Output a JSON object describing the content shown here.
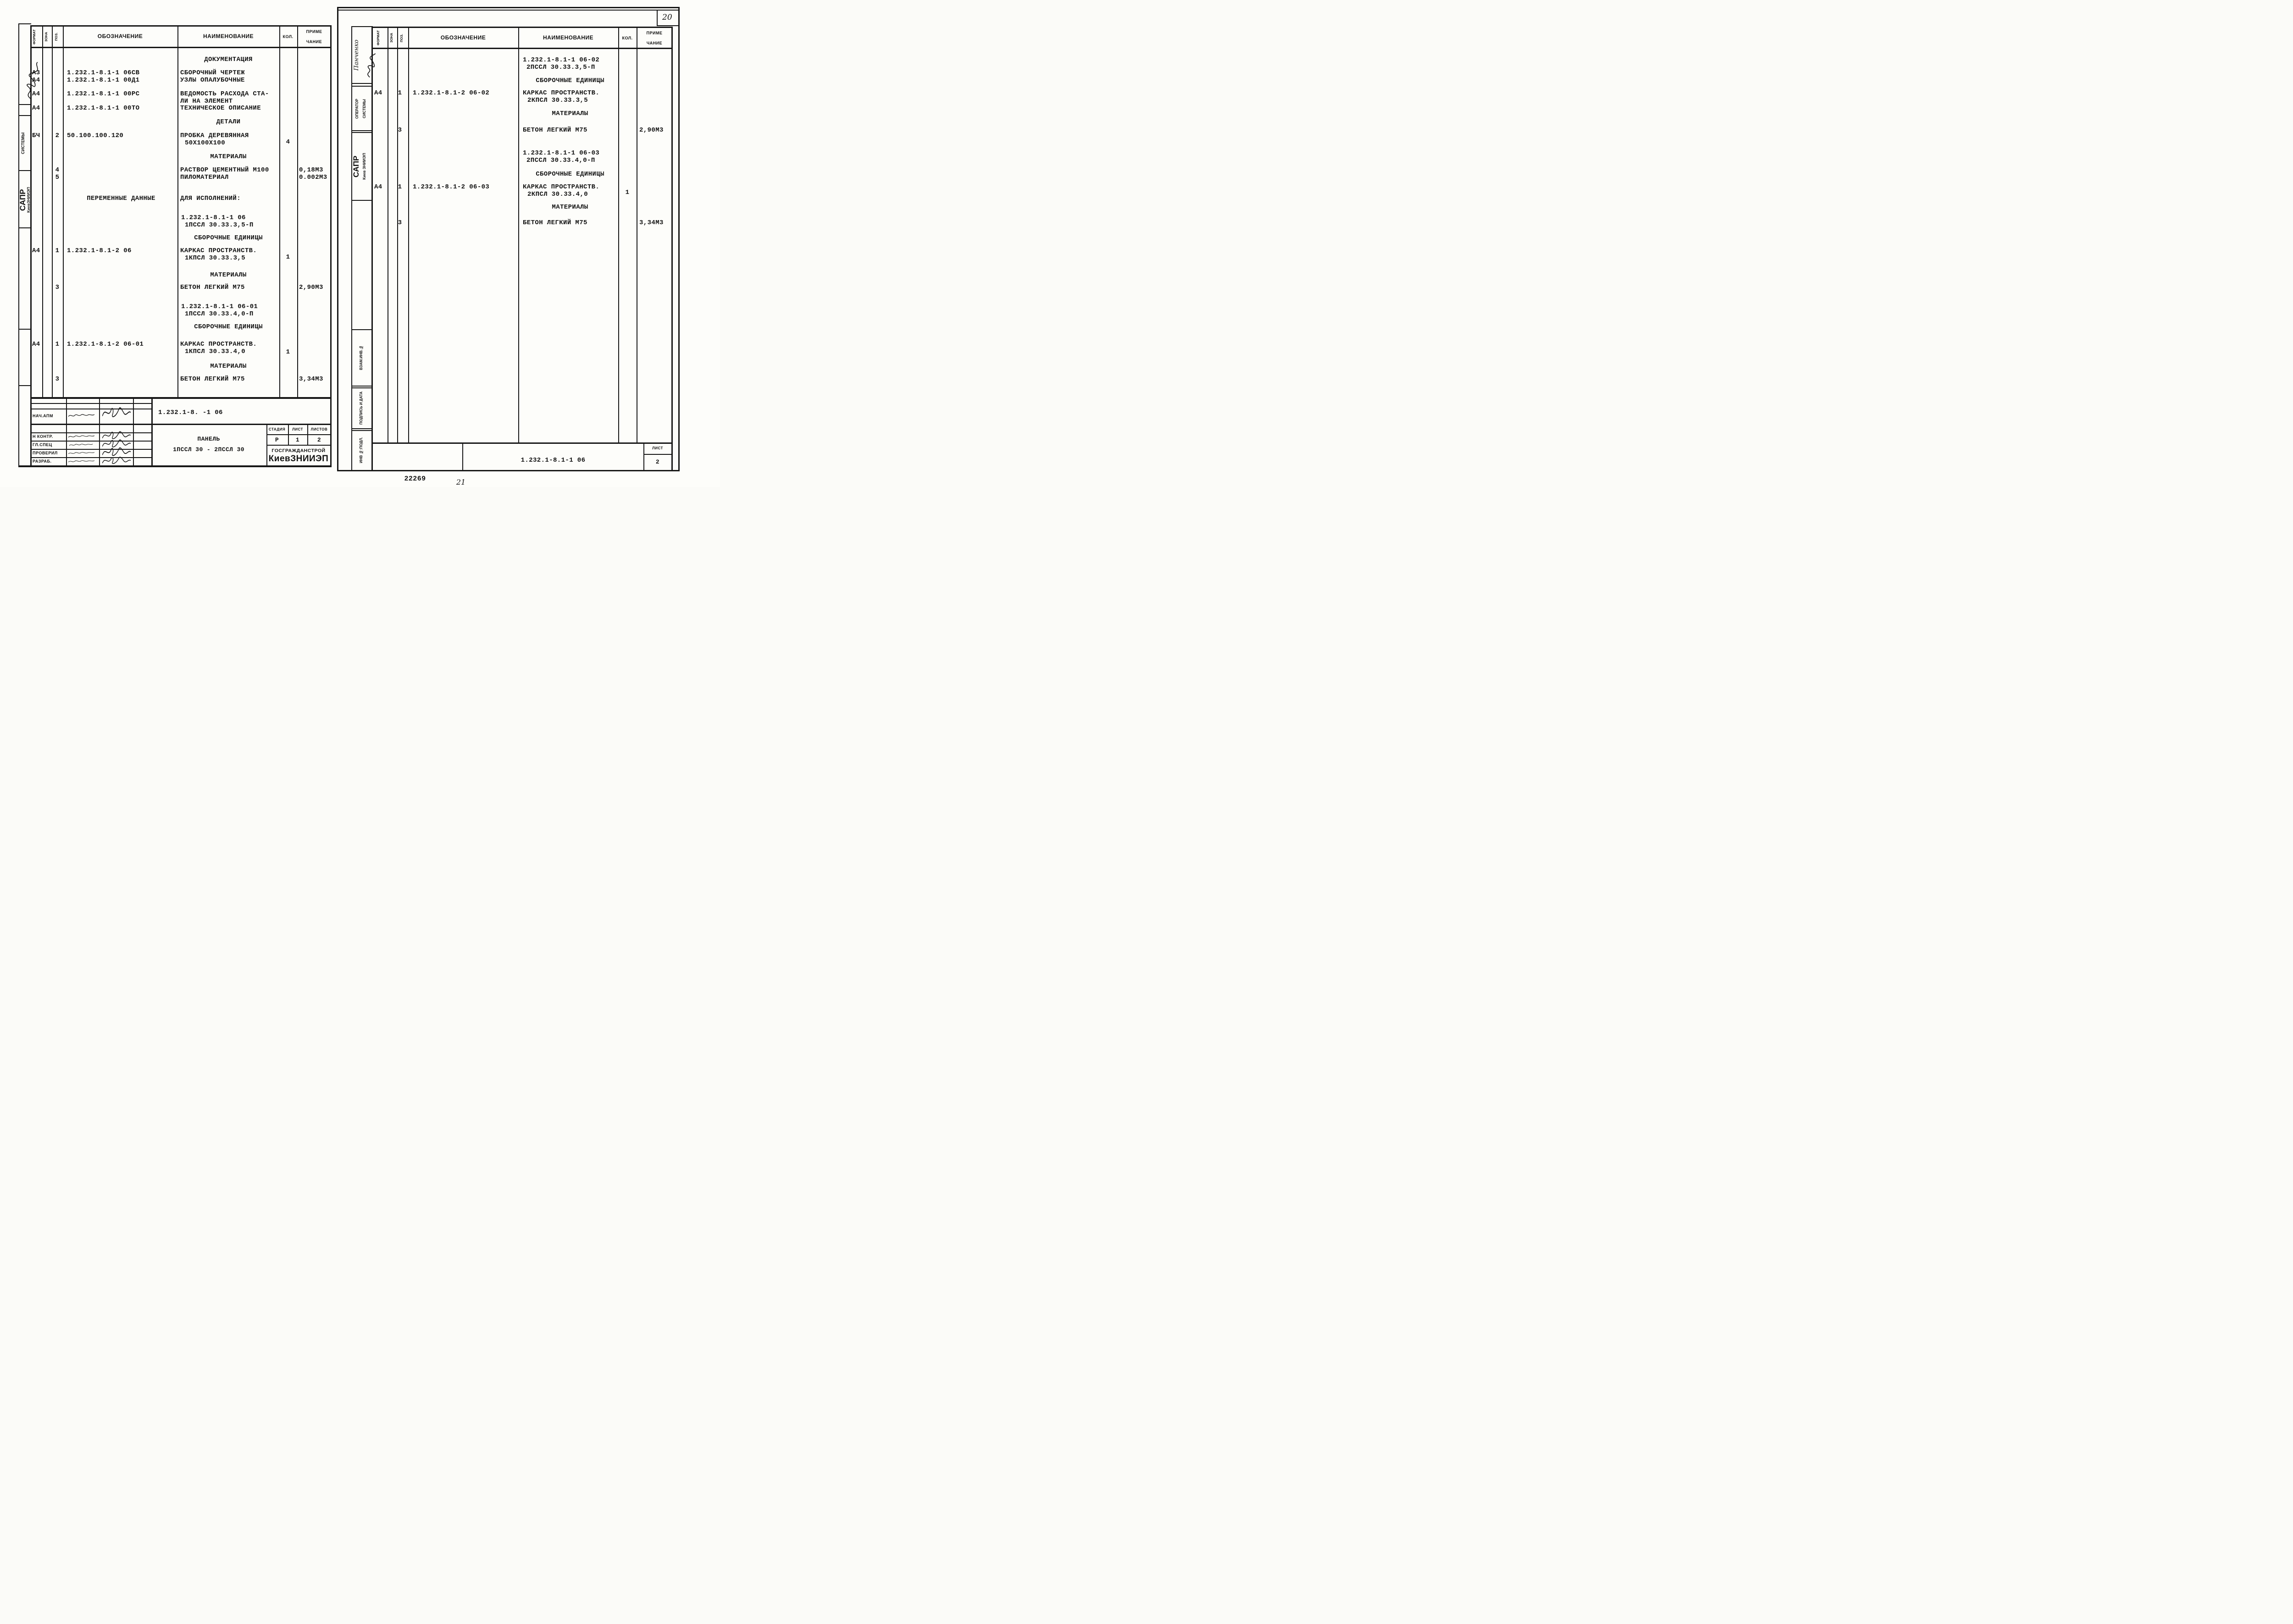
{
  "document": {
    "corner_page_number": "20",
    "stamp_number": "22269",
    "bottom_page_number": "21"
  },
  "table_headers": {
    "format": "ФОРМАТ",
    "zone": "ЗОНА",
    "pos": "ПОЗ.",
    "designation": "ОБОЗНАЧЕНИЕ",
    "name": "НАИМЕНОВАНИЕ",
    "qty": "КОЛ.",
    "note1": "ПРИМЕ",
    "note2": "ЧАНИЕ"
  },
  "left_sidebar": {
    "systems": "СИСТЕМЫ",
    "sapr": "САПР",
    "org": "КиевЗНИИЭП"
  },
  "right_sidebar": {
    "author": "Панченко",
    "operator_line1": "ОПЕРАТОР",
    "operator_line2": "СИСТЕМЫ",
    "sapr": "САПР",
    "org": "Киев ЗНИИЭП",
    "vzam": "ВЗАМ.ИНВ.№",
    "podpis": "ПОДПИСЬ И ДАТА",
    "inv": "ИНВ №:ПОДЛ."
  },
  "left_page": {
    "rows": [
      {
        "name1": "ДОКУМЕНТАЦИЯ"
      },
      {
        "format": "А3",
        "designation": "1.232.1-8.1-1 06СВ",
        "name1": "СБОРОЧНЫЙ ЧЕРТЕЖ"
      },
      {
        "format": "А4",
        "designation": "1.232.1-8.1-1 00Д1",
        "name1": "УЗЛЫ ОПАЛУБОЧНЫЕ"
      },
      {
        "format": "А4",
        "designation": "1.232.1-8.1-1 00РС",
        "name1": "ВЕДОМОСТЬ РАСХОДА СТА-",
        "name2": "ЛИ НА ЭЛЕМЕНТ"
      },
      {
        "format": "А4",
        "designation": "1.232.1-8.1-1 00ТО",
        "name1": "ТЕХНИЧЕСКОЕ ОПИСАНИЕ"
      },
      {
        "name1": "ДЕТАЛИ"
      },
      {
        "format": "БЧ",
        "pos": "2",
        "designation": "50.100.100.120",
        "name1": "ПРОБКА ДЕРЕВЯННАЯ",
        "name2": "50X100X100",
        "qty": "4"
      },
      {
        "name1": "МАТЕРИАЛЫ"
      },
      {
        "pos": "4",
        "name1": "РАСТВОР ЦЕМЕНТНЫЙ М100",
        "note": "0,18М3"
      },
      {
        "pos": "5",
        "name1": "ПИЛОМАТЕРИАЛ",
        "note": "0.002М3"
      },
      {
        "designation": "ПЕРЕМЕННЫЕ ДАННЫЕ",
        "name1": "ДЛЯ ИСПОЛНЕНИЙ:"
      },
      {
        "name1": "1.232.1-8.1-1 06",
        "name2": "1ПССЛ 30.33.3,5-П"
      },
      {
        "name1": "СБОРОЧНЫЕ ЕДИНИЦЫ"
      },
      {
        "format": "А4",
        "pos": "1",
        "designation": "1.232.1-8.1-2 06",
        "name1": "КАРКАС ПРОСТРАНСТВ.",
        "name2": "1КПСЛ 30.33.3,5",
        "qty": "1"
      },
      {
        "name1": "МАТЕРИАЛЫ"
      },
      {
        "pos": "3",
        "name1": "БЕТОН ЛЕГКИЙ М75",
        "note": "2,90М3"
      },
      {
        "name1": "1.232.1-8.1-1 06-01",
        "name2": "1ПССЛ 30.33.4,0-П"
      },
      {
        "name1": "СБОРОЧНЫЕ ЕДИНИЦЫ"
      },
      {
        "format": "А4",
        "pos": "1",
        "designation": "1.232.1-8.1-2 06-01",
        "name1": "КАРКАС ПРОСТРАНСТВ.",
        "name2": "1КПСЛ 30.33.4,0",
        "qty": "1"
      },
      {
        "name1": "МАТЕРИАЛЫ"
      },
      {
        "pos": "3",
        "name1": "БЕТОН ЛЕГКИЙ М75",
        "note": "3,34М3"
      }
    ]
  },
  "right_page": {
    "rows": [
      {
        "name1": "1.232.1-8.1-1 06-02",
        "name2": "2ПССЛ 30.33.3,5-П"
      },
      {
        "name1": "СБОРОЧНЫЕ ЕДИНИЦЫ"
      },
      {
        "format": "А4",
        "pos": "1",
        "designation": "1.232.1-8.1-2 06-02",
        "name1": "КАРКАС ПРОСТРАНСТВ.",
        "name2": "2КПСЛ 30.33.3,5"
      },
      {
        "name1": "МАТЕРИАЛЫ"
      },
      {
        "pos": "3",
        "name1": "БЕТОН ЛЕГКИЙ М75",
        "note": "2,90М3"
      },
      {
        "name1": "1.232.1-8.1-1 06-03",
        "name2": "2ПССЛ 30.33.4,0-П"
      },
      {
        "name1": "СБОРОЧНЫЕ ЕДИНИЦЫ"
      },
      {
        "format": "А4",
        "pos": "1",
        "designation": "1.232.1-8.1-2 06-03",
        "name1": "КАРКАС ПРОСТРАНСТВ.",
        "name2": "2КПСЛ 30.33.4,0",
        "qty": "1"
      },
      {
        "name1": "МАТЕРИАЛЫ"
      },
      {
        "pos": "3",
        "name1": "БЕТОН ЛЕГКИЙ М75",
        "note": "3,34М3"
      }
    ]
  },
  "left_title_block": {
    "doc_number": "1.232.1-8. -1 06",
    "labels": {
      "nach_apm": "НАЧ.АПМ",
      "n_kontr": "Н КОНТР.",
      "gl_spec": "ГЛ.СПЕЦ",
      "proveril": "ПРОВЕРИЛ",
      "razrab": "РАЗРАБ."
    },
    "product_line1": "ПАНЕЛЬ",
    "product_line2": "1ПССЛ 30 - 2ПССЛ 30",
    "stage_label": "СТАДИЯ",
    "stage_value": "Р",
    "sheet_label": "ЛИСТ",
    "sheet_value": "1",
    "sheets_label": "ЛИСТОВ",
    "sheets_value": "2",
    "org_line1": "ГОСГРАЖДАНСТРОЙ",
    "org_line2": "КиевЗНИИЭП"
  },
  "right_title_block": {
    "doc_number": "1.232.1-8.1-1 06",
    "sheet_label": "ЛИСТ",
    "sheet_value": "2"
  }
}
